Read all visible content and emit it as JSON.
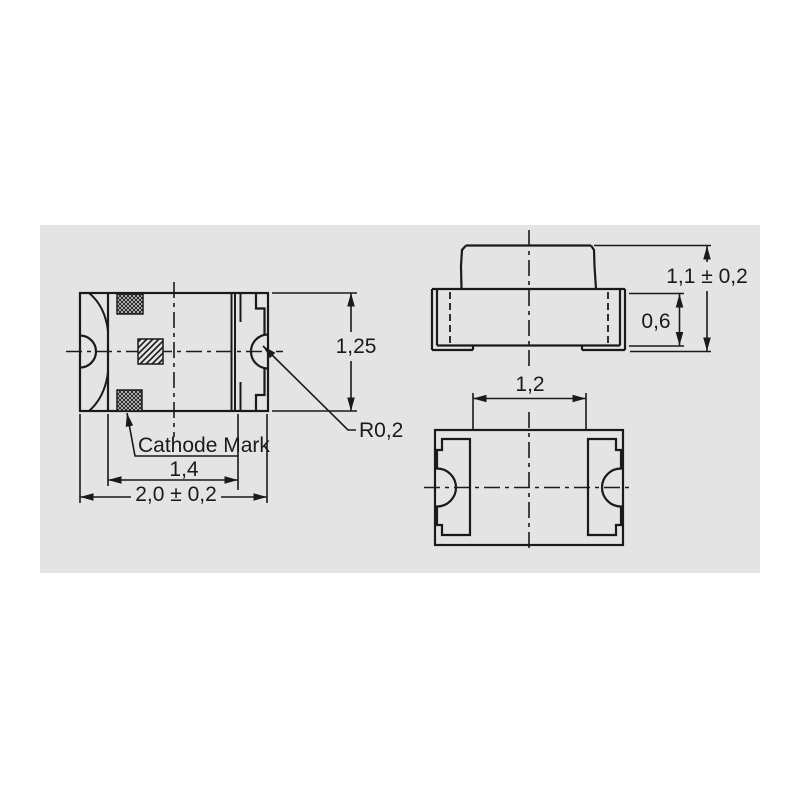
{
  "drawing": {
    "type": "technical-dimension-drawing",
    "subject": "SMD chip LED package outline, three orthographic views"
  },
  "colors": {
    "page_bg": "#ffffff",
    "canvas_bg": "#e4e4e4",
    "line": "#1a1a1a"
  },
  "labels": {
    "top_height": "1,25",
    "notch_radius": "R0,2",
    "cathode_mark": "Cathode Mark",
    "terminal_span": "1,4",
    "overall_length": "2,0 ± 0,2",
    "overall_height": "1,1 ± 0,2",
    "body_height": "0,6",
    "pad_spacing": "1,2"
  }
}
